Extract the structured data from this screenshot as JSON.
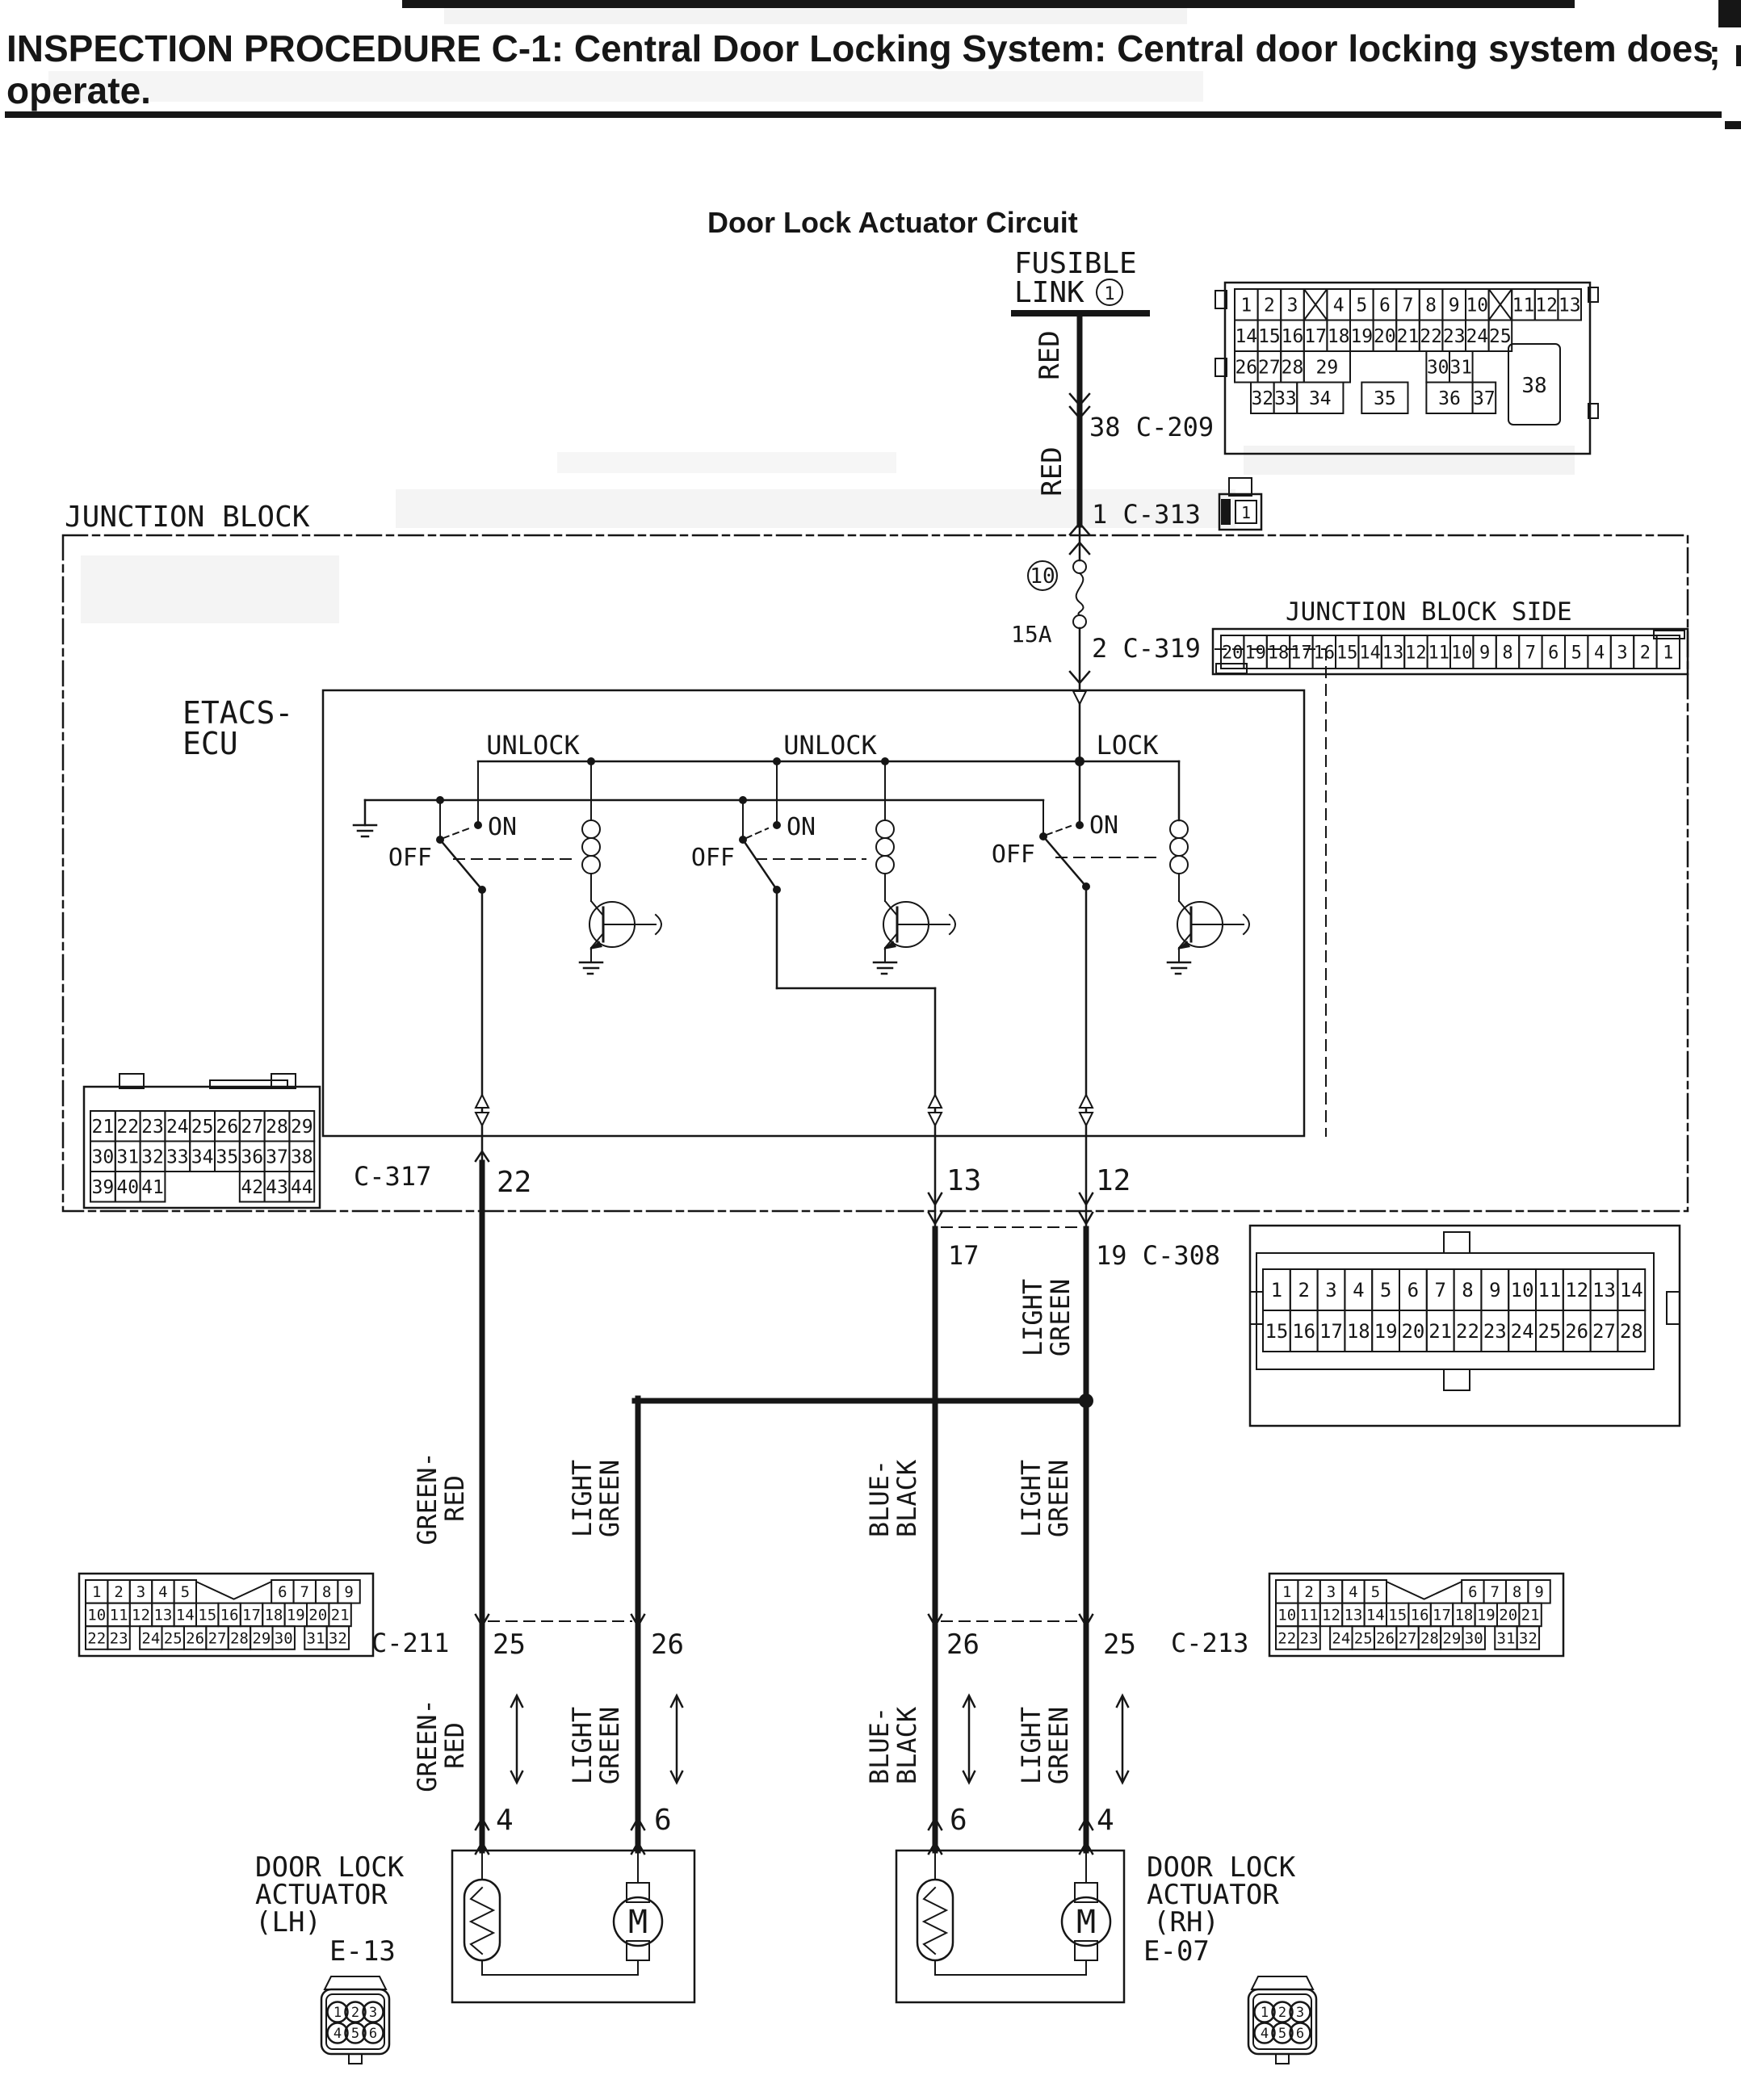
{
  "title": {
    "line1": "INSPECTION PROCEDURE C-1: Central Door Locking System: Central door locking system does",
    "line2": "operate.",
    "edge_fragment": ";"
  },
  "heading": "Door Lock Actuator Circuit",
  "power": {
    "fusible_line1": "FUSIBLE",
    "fusible_line2": "LINK",
    "fusible_num": "1",
    "wire_color": "RED",
    "ref_c209": "38 C-209",
    "ref_c313": "1 C-313",
    "c313_pin": "1",
    "fuse_num": "10",
    "fuse_rating": "15A",
    "ref_c319": "2 C-319"
  },
  "junction_block": {
    "label": "JUNCTION BLOCK",
    "side_label": "JUNCTION BLOCK SIDE"
  },
  "etacs": {
    "line1": "ETACS-",
    "line2": "ECU",
    "unlock": "UNLOCK",
    "lock": "LOCK",
    "on": "ON",
    "off": "OFF"
  },
  "pins": {
    "p22": "22",
    "p13": "13",
    "p12": "12",
    "p17": "17",
    "p19_ref": "19 C-308",
    "p25": "25",
    "p26": "26",
    "p4": "4",
    "p6": "6"
  },
  "refs": {
    "c317": "C-317",
    "c211": "C-211",
    "c213": "C-213"
  },
  "wire_colors": {
    "green_red": [
      "GREEN-",
      "RED"
    ],
    "light_green": [
      "LIGHT",
      "GREEN"
    ],
    "blue_black": [
      "BLUE-",
      "BLACK"
    ]
  },
  "actuators": {
    "motor": "M",
    "lh": {
      "line1": "DOOR LOCK",
      "line2": "ACTUATOR",
      "line3": "(LH)",
      "conn": "E-13"
    },
    "rh": {
      "line1": "DOOR LOCK",
      "line2": "ACTUATOR",
      "line3": "(RH)",
      "conn": "E-07"
    }
  },
  "connector_grids": {
    "c209": {
      "big": "38",
      "rows": [
        [
          "1",
          "2",
          "3",
          {
            "cross": true
          },
          "4",
          "5",
          "6",
          "7",
          "8",
          "9",
          "10",
          {
            "cross": true
          },
          "11",
          "12",
          "13"
        ],
        [
          "14",
          "15",
          "16",
          "17",
          "18",
          "19",
          "20",
          "21",
          "22",
          "23",
          "24",
          "25"
        ],
        [
          "26",
          "27",
          "28",
          {
            "l": "29",
            "w": 2
          },
          {
            "gap": 3.3
          },
          "30",
          "31"
        ],
        [
          {
            "gap": 0.7
          },
          "32",
          "33",
          {
            "l": "34",
            "w": 2
          },
          {
            "gap": 0.8
          },
          {
            "l": "35",
            "w": 2
          },
          {
            "gap": 0.8
          },
          {
            "l": "36",
            "w": 2
          },
          "37"
        ]
      ]
    },
    "jb_side": {
      "rows": [
        [
          "20",
          "19",
          "18",
          "17",
          "16",
          "15",
          "14",
          "13",
          "12",
          "11",
          "10",
          "9",
          "8",
          "7",
          "6",
          "5",
          "4",
          "3",
          "2",
          "1"
        ]
      ]
    },
    "c317": {
      "rows": [
        [
          "21",
          "22",
          "23",
          "24",
          "25",
          "26",
          "27",
          "28",
          "29"
        ],
        [
          "30",
          "31",
          "32",
          "33",
          "34",
          "35",
          "36",
          "37",
          "38"
        ],
        [
          "39",
          "40",
          "41",
          {
            "gap": 3
          },
          "42",
          "43",
          "44"
        ]
      ]
    },
    "c308": {
      "rows": [
        [
          "1",
          "2",
          "3",
          "4",
          "5",
          "6",
          "7",
          "8",
          "9",
          "10",
          "11",
          "12",
          "13",
          "14"
        ],
        [
          "15",
          "16",
          "17",
          "18",
          "19",
          "20",
          "21",
          "22",
          "23",
          "24",
          "25",
          "26",
          "27",
          "28"
        ]
      ]
    },
    "c211": {
      "rows": [
        [
          "1",
          "2",
          "3",
          "4",
          "5",
          {
            "gap": 3.4,
            "notch": true
          },
          "6",
          "7",
          "8",
          "9"
        ],
        [
          "10",
          "11",
          "12",
          "13",
          "14",
          "15",
          "16",
          "17",
          "18",
          "19",
          "20",
          "21"
        ],
        [
          "22",
          "23",
          {
            "gap": 0.45
          },
          "24",
          "25",
          "26",
          "27",
          "28",
          "29",
          "30",
          {
            "gap": 0.45
          },
          "31",
          "32"
        ]
      ]
    },
    "c213": {
      "rows": [
        [
          "1",
          "2",
          "3",
          "4",
          "5",
          {
            "gap": 3.4,
            "notch": true
          },
          "6",
          "7",
          "8",
          "9"
        ],
        [
          "10",
          "11",
          "12",
          "13",
          "14",
          "15",
          "16",
          "17",
          "18",
          "19",
          "20",
          "21"
        ],
        [
          "22",
          "23",
          {
            "gap": 0.45
          },
          "24",
          "25",
          "26",
          "27",
          "28",
          "29",
          "30",
          {
            "gap": 0.45
          },
          "31",
          "32"
        ]
      ]
    },
    "e13": {
      "rows": [
        [
          "1",
          "2",
          "3"
        ],
        [
          "4",
          "5",
          "6"
        ]
      ]
    },
    "e07": {
      "rows": [
        [
          "1",
          "2",
          "3"
        ],
        [
          "4",
          "5",
          "6"
        ]
      ]
    }
  }
}
